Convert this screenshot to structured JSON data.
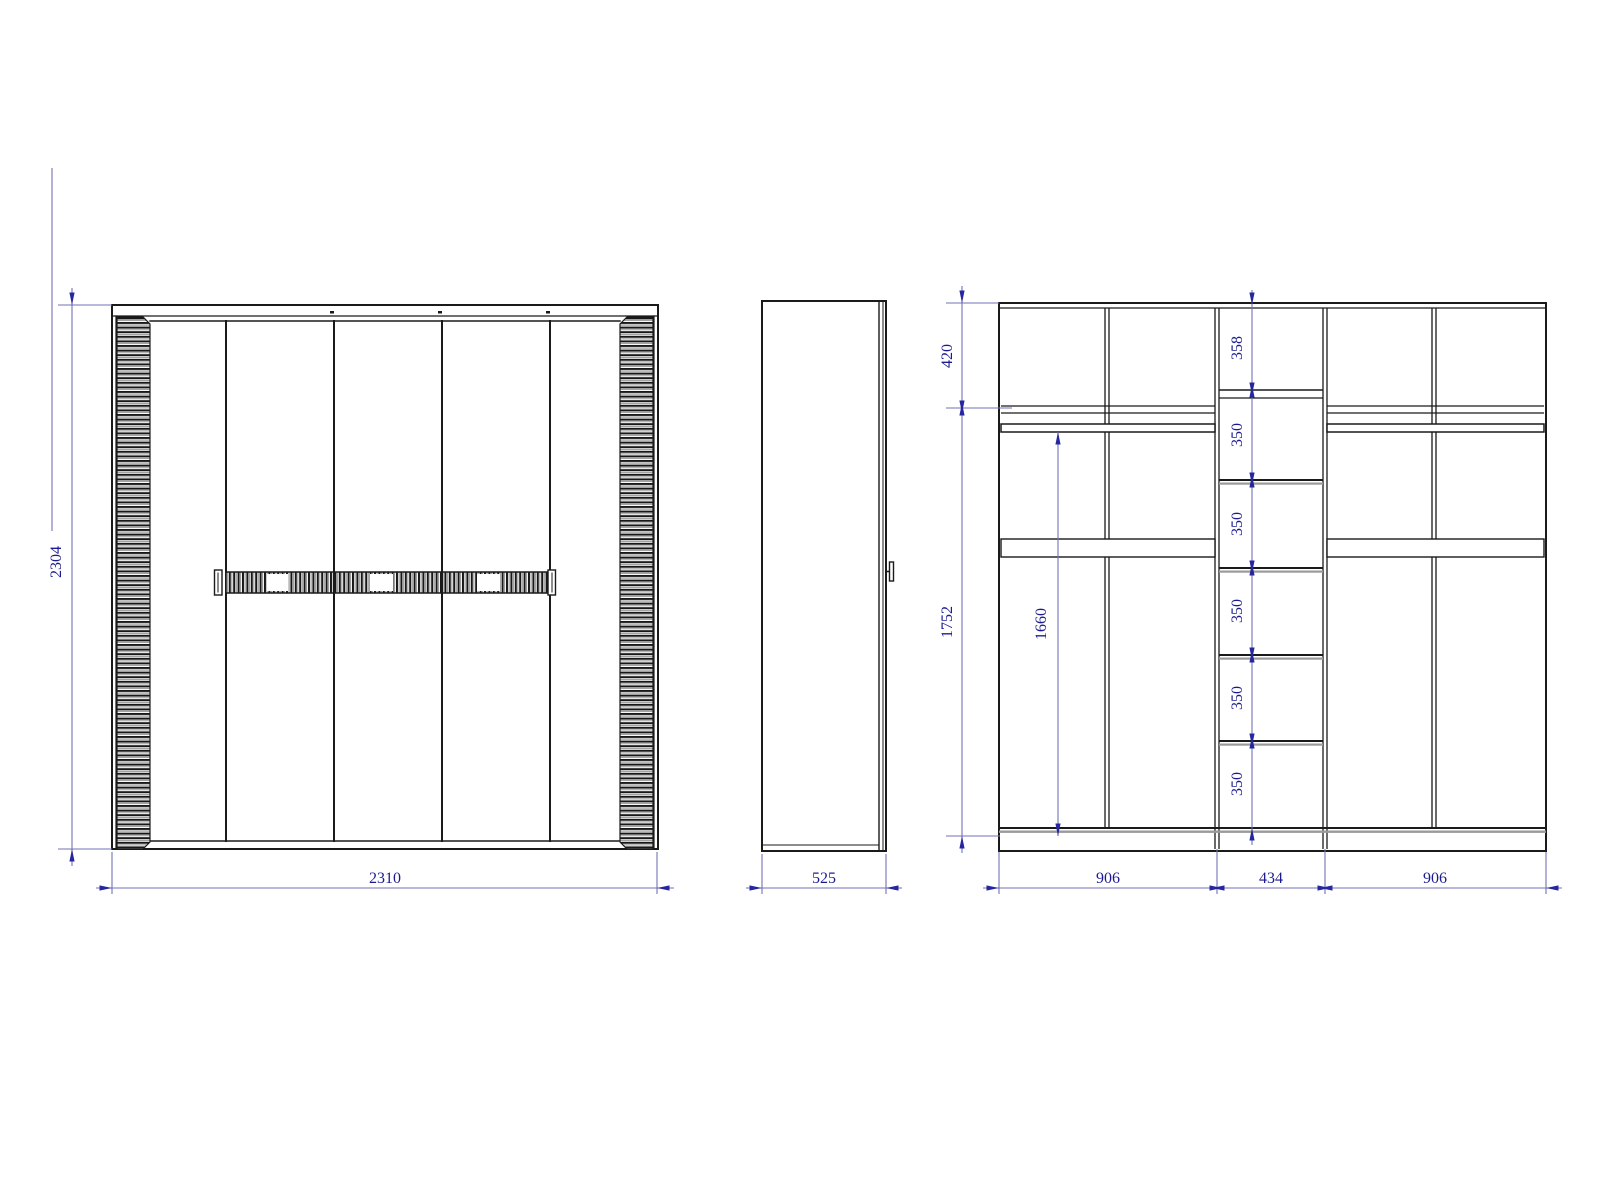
{
  "drawing": {
    "type": "wardrobe-technical-drawing",
    "views": {
      "front": {
        "width_label": "2310",
        "height_label": "2304"
      },
      "side": {
        "depth_label": "525"
      },
      "internal": {
        "top_height_label": "420",
        "body_height_label": "1752",
        "hanging_height_label": "1660",
        "shelf_gap_labels": [
          "358",
          "350",
          "350",
          "350",
          "350",
          "350"
        ],
        "section_width_labels": [
          "906",
          "434",
          "906"
        ]
      }
    },
    "colors": {
      "line": "#1a1a1a",
      "shadow": "#9a9a9a",
      "dim_line": "#7272b4",
      "dim_text": "#1b1b8f",
      "arrow": "#26269e"
    }
  }
}
